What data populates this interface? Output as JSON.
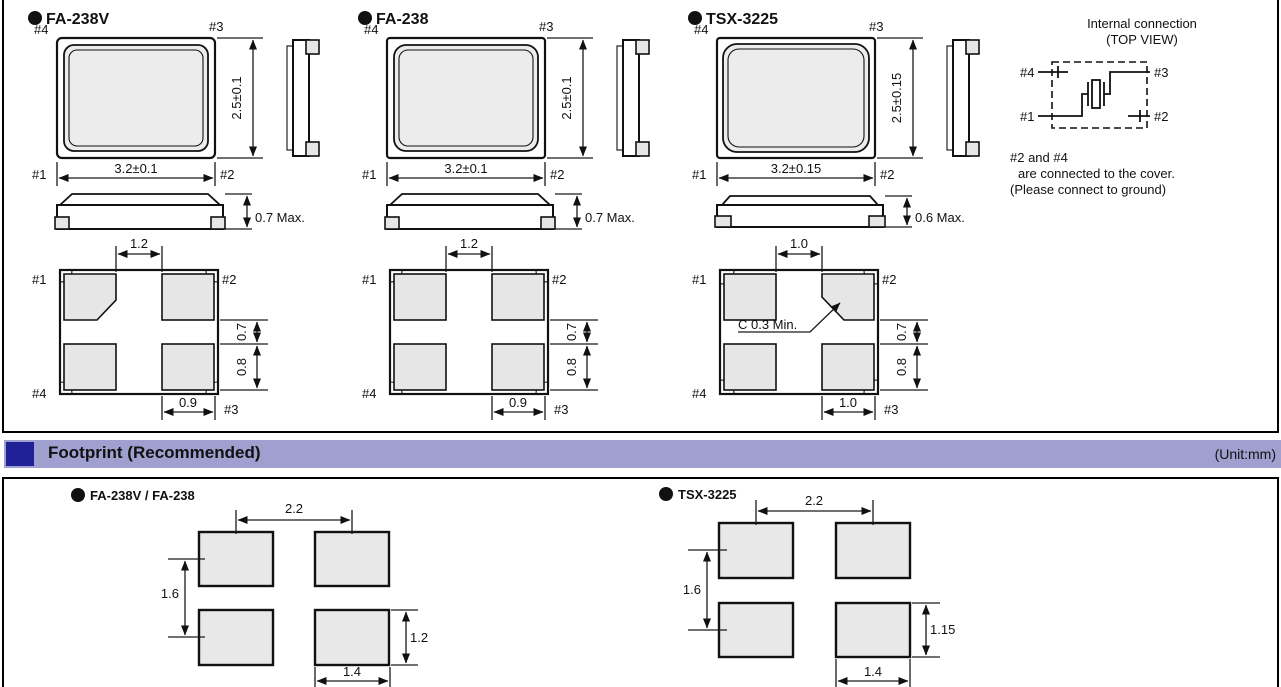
{
  "colors": {
    "outline": "#111111",
    "pad_fill": "#e6e6e6",
    "header_bg": "#9f9fd0",
    "header_accent": "#1f1f96"
  },
  "packages": [
    {
      "title": "FA-238V",
      "top_view": {
        "pin_top_left": "#4",
        "pin_top_right": "#3",
        "pin_bottom_left": "#1",
        "pin_bottom_right": "#2",
        "width_dim": "3.2±0.1",
        "height_dim": "2.5±0.1"
      },
      "side_profile": {
        "height_dim": "0.7 Max."
      },
      "bottom_view": {
        "pin_top_left": "#1",
        "pin_top_right": "#2",
        "pin_bottom_left": "#4",
        "pin_bottom_right": "#3",
        "top_gap_dim": "1.2",
        "side_gap_dim": "0.7",
        "pad_height_dim": "0.8",
        "pad_width_dim": "0.9"
      }
    },
    {
      "title": "FA-238",
      "top_view": {
        "pin_top_left": "#4",
        "pin_top_right": "#3",
        "pin_bottom_left": "#1",
        "pin_bottom_right": "#2",
        "width_dim": "3.2±0.1",
        "height_dim": "2.5±0.1"
      },
      "side_profile": {
        "height_dim": "0.7 Max."
      },
      "bottom_view": {
        "pin_top_left": "#1",
        "pin_top_right": "#2",
        "pin_bottom_left": "#4",
        "pin_bottom_right": "#3",
        "top_gap_dim": "1.2",
        "side_gap_dim": "0.7",
        "pad_height_dim": "0.8",
        "pad_width_dim": "0.9"
      }
    },
    {
      "title": "TSX-3225",
      "top_view": {
        "pin_top_left": "#4",
        "pin_top_right": "#3",
        "pin_bottom_left": "#1",
        "pin_bottom_right": "#2",
        "width_dim": "3.2±0.15",
        "height_dim": "2.5±0.15"
      },
      "side_profile": {
        "height_dim": "0.6 Max."
      },
      "bottom_view": {
        "pin_top_left": "#1",
        "pin_top_right": "#2",
        "pin_bottom_left": "#4",
        "pin_bottom_right": "#3",
        "top_gap_dim": "1.0",
        "side_gap_dim": "0.7",
        "pad_height_dim": "0.8",
        "pad_width_dim": "1.0",
        "chamfer_note": "C 0.3 Min."
      }
    }
  ],
  "internal_connection": {
    "title_line1": "Internal connection",
    "title_line2": "(TOP VIEW)",
    "pin_top_left": "#4",
    "pin_top_right": "#3",
    "pin_bottom_left": "#1",
    "pin_bottom_right": "#2",
    "note_line1": "#2 and #4",
    "note_line2": "are connected to the cover.",
    "note_line3": "(Please connect to ground)"
  },
  "footprint_section": {
    "header_title": "Footprint (Recommended)",
    "unit_label": "(Unit:mm)"
  },
  "footprints": [
    {
      "title": "FA-238V / FA-238",
      "pitch_x": "2.2",
      "pitch_y": "1.6",
      "pad_height": "1.2",
      "pad_width": "1.4"
    },
    {
      "title": "TSX-3225",
      "pitch_x": "2.2",
      "pitch_y": "1.6",
      "pad_height": "1.15",
      "pad_width": "1.4"
    }
  ]
}
